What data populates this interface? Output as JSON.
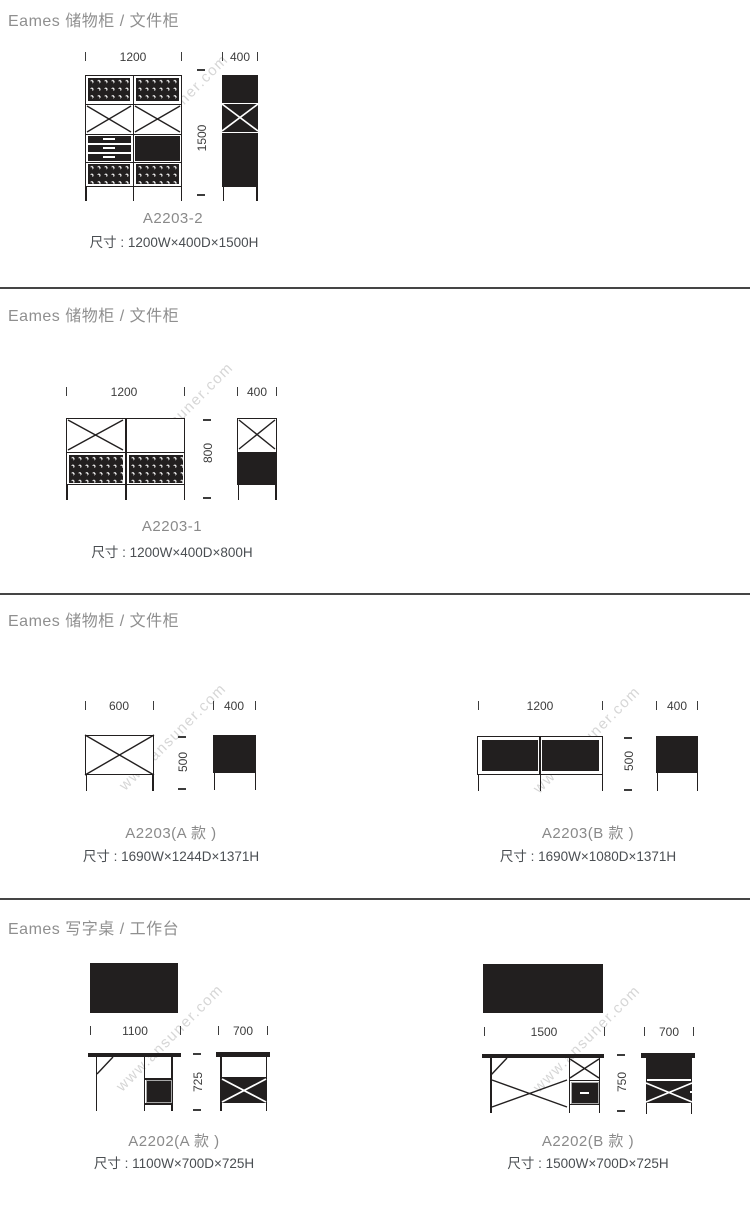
{
  "watermark": "www.ansuner.com",
  "colors": {
    "ink": "#221f1f",
    "heading": "#8f8f8f",
    "model_text": "#8a8a8a",
    "size_text": "#4a4e52",
    "watermark": "#d6d6d6"
  },
  "sections": [
    {
      "title": "Eames 储物柜 / 文件柜",
      "products": [
        {
          "model": "A2203-2",
          "size": "尺寸 : 1200W×400D×1500H",
          "front_width": "1200",
          "side_depth": "400",
          "height": "1500"
        }
      ]
    },
    {
      "title": "Eames 储物柜 / 文件柜",
      "products": [
        {
          "model": "A2203-1",
          "size": "尺寸 : 1200W×400D×800H",
          "front_width": "1200",
          "side_depth": "400",
          "height": "800"
        }
      ]
    },
    {
      "title": "Eames 储物柜 / 文件柜",
      "products": [
        {
          "model": "A2203(A 款 )",
          "size": "尺寸 : 1690W×1244D×1371H",
          "front_width": "600",
          "side_depth": "400",
          "height": "500"
        },
        {
          "model": "A2203(B 款 )",
          "size": "尺寸 : 1690W×1080D×1371H",
          "front_width": "1200",
          "side_depth": "400",
          "height": "500"
        }
      ]
    },
    {
      "title": "Eames 写字桌 / 工作台",
      "products": [
        {
          "model": "A2202(A 款 )",
          "size": "尺寸 : 1100W×700D×725H",
          "front_width": "1100",
          "side_depth": "700",
          "height": "725"
        },
        {
          "model": "A2202(B 款 )",
          "size": "尺寸 : 1500W×700D×725H",
          "front_width": "1500",
          "side_depth": "700",
          "height": "750"
        }
      ]
    }
  ]
}
